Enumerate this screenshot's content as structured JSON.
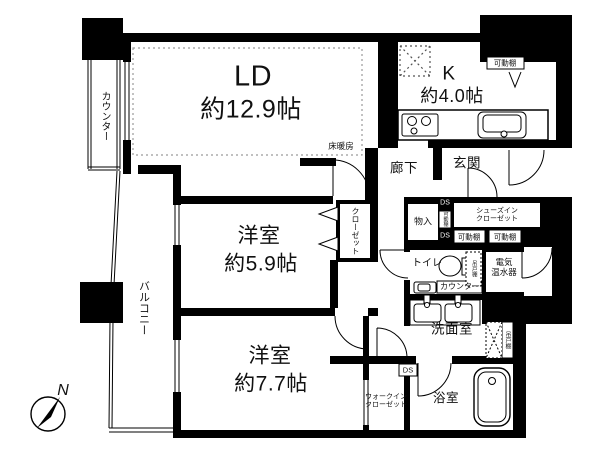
{
  "colors": {
    "wall": "#000000",
    "background": "#ffffff",
    "dotted_line": "#9a9a9a"
  },
  "compass": {
    "north": "N"
  },
  "rooms": {
    "living_dining": {
      "name": "LD",
      "area": "約12.9帖"
    },
    "kitchen": {
      "name": "K",
      "area": "約4.0帖"
    },
    "western_room_59": {
      "name": "洋室",
      "area": "約5.9帖"
    },
    "western_room_77": {
      "name": "洋室",
      "area": "約7.7帖"
    },
    "corridor": "廊下",
    "entrance": "玄関",
    "toilet": "トイレ",
    "washroom": "洗面室",
    "bathroom": "浴室",
    "water_heater": {
      "line1": "電気",
      "line2": "温水器"
    },
    "walk_in_closet": {
      "line1": "ウォークイン",
      "line2": "クローゼット"
    },
    "shoes_in_closet": {
      "line1": "シューズイン",
      "line2": "クローゼット"
    }
  },
  "features": {
    "balcony": "バルコニー",
    "counter": "カウンター",
    "floor_heating": "床暖房",
    "closet": "クローゼット",
    "storage": "物入",
    "movable_shelf": "可動棚",
    "duct_space": "DS",
    "hanging_cupboard": "吊戸棚"
  }
}
